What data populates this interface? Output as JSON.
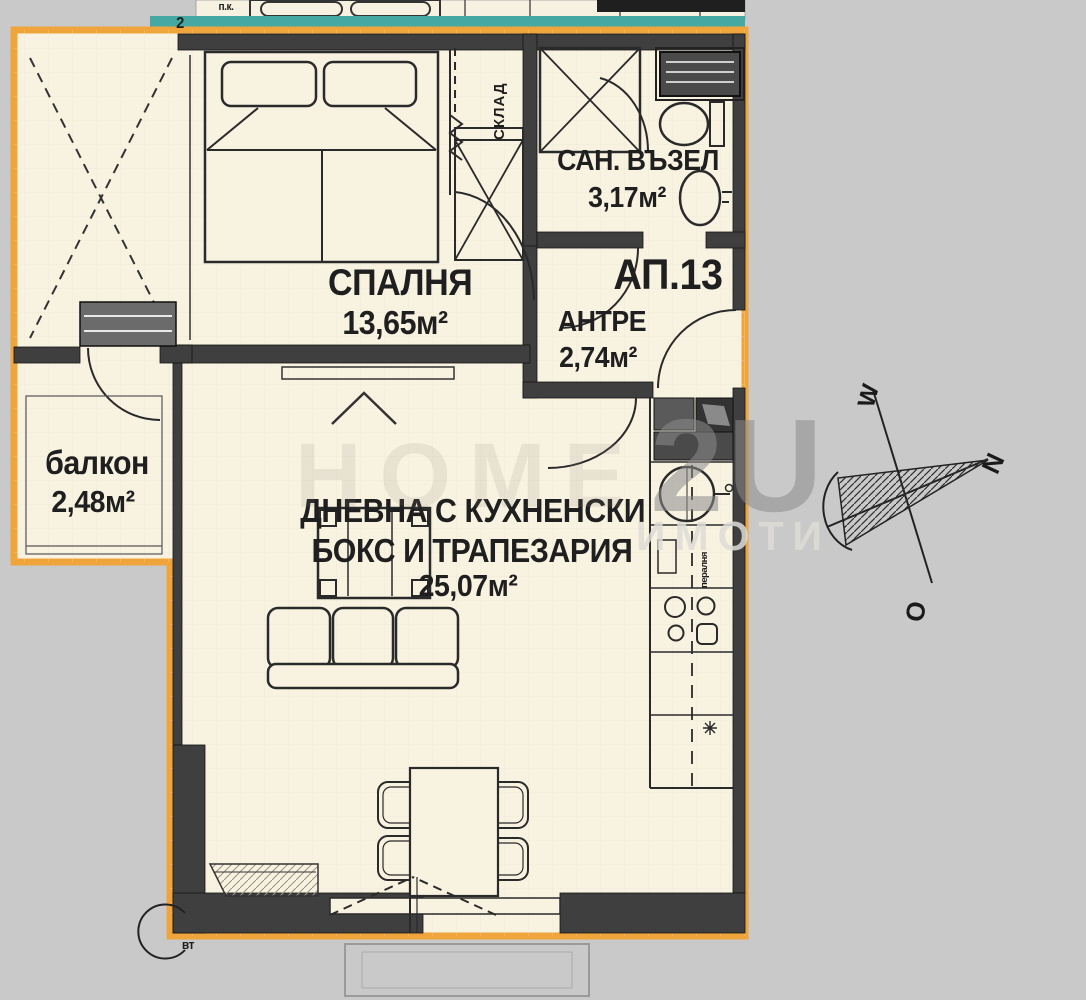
{
  "colors": {
    "background": "#C9C9C9",
    "paper": "#F8F2E1",
    "outline": "#F0A53C",
    "teal": "#45A8A2",
    "wall": "#3F3F3F",
    "ink": "#1F1F1F"
  },
  "labels": {
    "apartment": "АП.13",
    "bedroom_name": "СПАЛНЯ",
    "bedroom_area": "13,65м²",
    "bath_name": "САН. ВЪЗЕЛ",
    "bath_area": "3,17м²",
    "hall_name": "АНТРЕ",
    "hall_area": "2,74м²",
    "balcony_name": "балкон",
    "balcony_area": "2,48м²",
    "living_name1": "ДНЕВНА С КУХНЕНСКИ",
    "living_name2": "БОКС И ТРАПЕЗАРИЯ",
    "living_area": "25,07м²",
    "storage": "СКЛАД",
    "washer": "пералня",
    "vent": "вт",
    "top_note": "п.к.",
    "wall_mark": "2"
  },
  "compass": {
    "up": "W",
    "right": "N",
    "down": "O"
  },
  "watermark": {
    "left": "HOME",
    "big": "2U",
    "sub": "ИМОТИ"
  }
}
